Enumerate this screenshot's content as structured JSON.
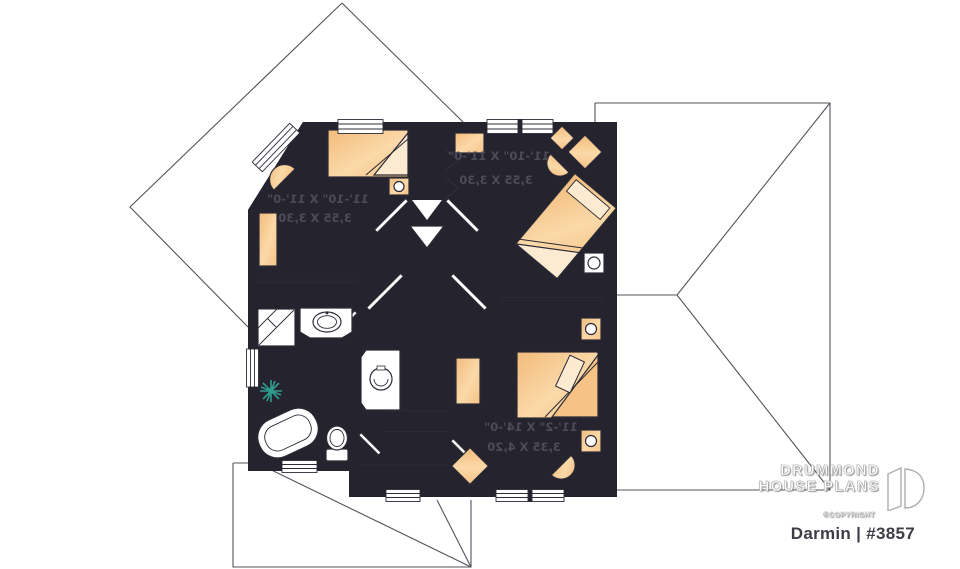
{
  "footer": {
    "brand_line1": "DRUMMOND",
    "brand_line2": "HOUSE PLANS",
    "copyright_label": "©COPYRIGHT",
    "plan_title": "Darmin | #3857"
  },
  "rooms": {
    "bedroom_top_left": {
      "dim_imperial": "11'-10\" X 11'-0\"",
      "dim_metric": "3,55 X 3,30"
    },
    "bedroom_top_right": {
      "dim_imperial": "11'-10\" X 11'-0\"",
      "dim_metric": "3,55 X 3,30"
    },
    "master_bedroom": {
      "dim_imperial": "11'-2\" X 14'-0\"",
      "dim_metric": "3,35 X 4,20"
    }
  },
  "style": {
    "wall_color": "#24232e",
    "floor_tint": "#c9d6ec",
    "furniture_color": "#f6c88f",
    "bathroom_tile_color": "#e3f2ec",
    "plant_color": "#2f9d8e",
    "roof_line_color": "#54535c",
    "label_color": "#4c4c58",
    "title_color": "#3e3d47",
    "text_mirrored": true
  }
}
